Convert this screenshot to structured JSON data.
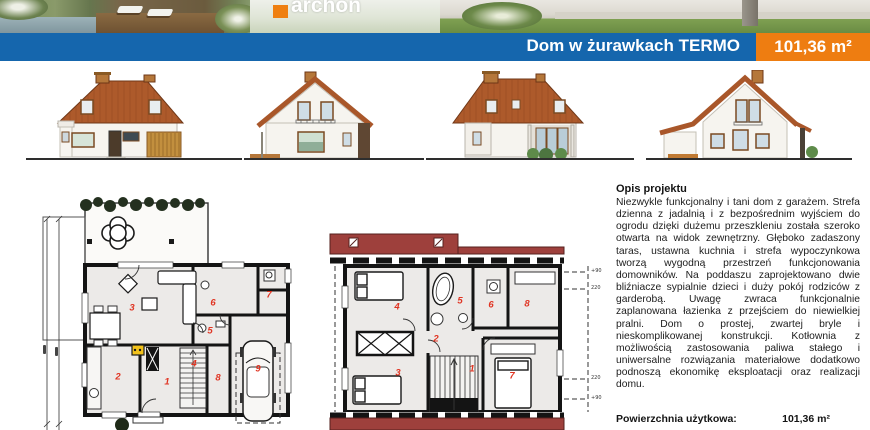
{
  "branding": {
    "logo_text": "archon",
    "logo_color": "#ef7f10"
  },
  "header": {
    "title": "Dom w żurawkach TERMO",
    "area_badge": "101,36 m²",
    "bar_color": "#1566ad",
    "badge_color": "#ee7d11"
  },
  "elevations": {
    "icons": [
      "front-elevation",
      "left-gable-elevation",
      "rear-elevation",
      "right-gable-elevation"
    ],
    "roof_color": "#ad5a2b"
  },
  "description": {
    "heading": "Opis projektu",
    "body": "Niezwykle funkcjonalny i tani dom z garażem. Strefa dzienna z jadalnią i z bezpośrednim wyjściem do ogrodu dzięki dużemu przeszkleniu została szeroko otwarta na widok zewnętrzny. Głęboko zadaszony taras, ustawna kuchnia i strefa wypoczynkowa tworzą wygodną przestrzeń funkcjonowania domowników. Na poddaszu zaprojektowano dwie bliźniacze sypialnie dzieci i duży pokój rodziców z garderobą. Uwagę zwraca funkcjonalnie zaplanowana łazienka z przejściem do niewielkiej pralni. Dom o prostej, zwartej bryle i nieskomplikowanej konstrukcji. Kotłownia z możliwością zastosowania paliwa stałego i uniwersalne rozwiązania materiałowe dodatkowo podnoszą ekonomikę eksploatacji oraz realizacji domu."
  },
  "area": {
    "label": "Powierzchnia użytkowa:",
    "value": "101,36 m²"
  },
  "plans": {
    "ground": {
      "rooms": [
        "1",
        "2",
        "3",
        "4",
        "5",
        "6",
        "7",
        "8",
        "9"
      ],
      "number_color": "#e03422"
    },
    "attic": {
      "rooms": [
        "1",
        "2",
        "3",
        "4",
        "5",
        "6",
        "7",
        "8"
      ],
      "marks": [
        "+90",
        "220",
        "220",
        "+90"
      ],
      "roof_band_color": "#9e403c"
    }
  }
}
